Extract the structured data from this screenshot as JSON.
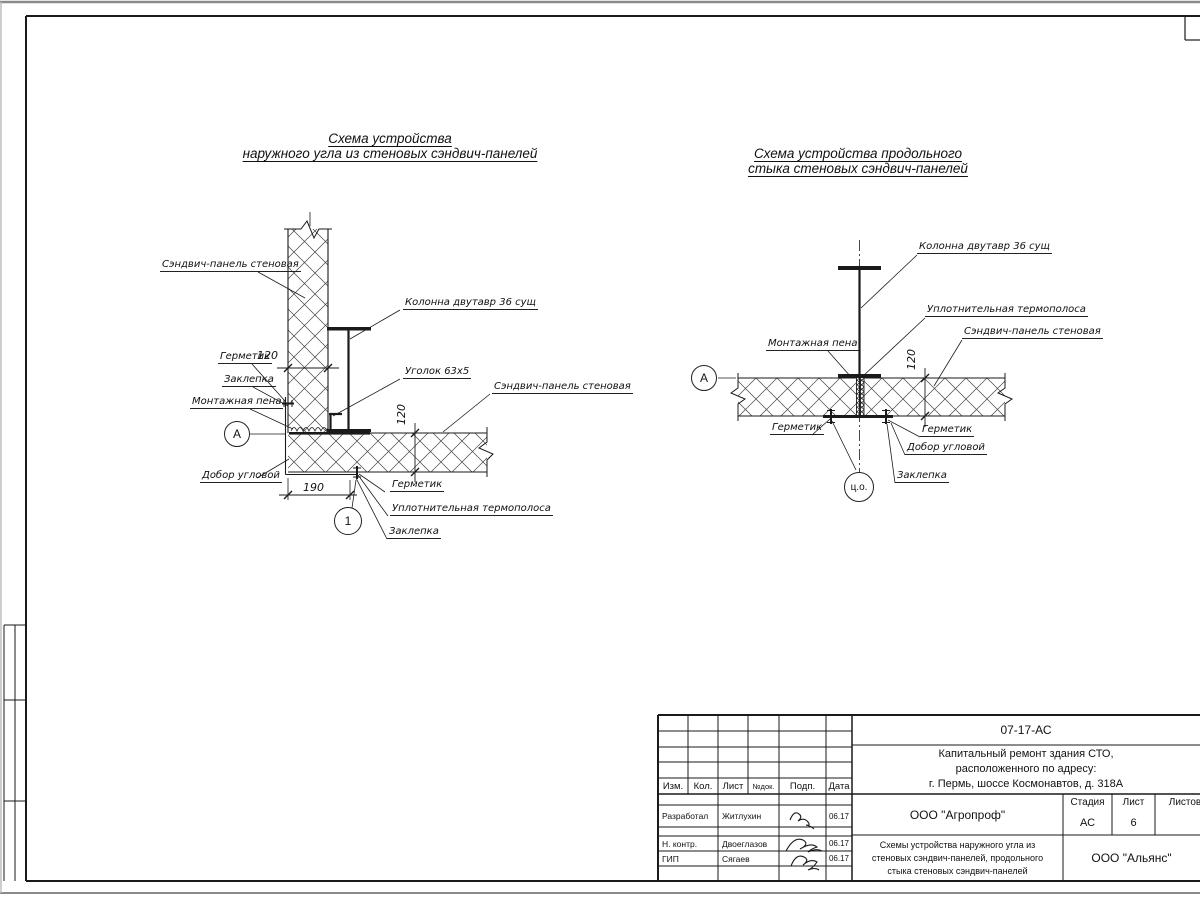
{
  "diagram_left": {
    "title1": "Схема устройства",
    "title2": "наружного угла из стеновых сэндвич-панелей",
    "label_panel": "Сэндвич-панель стеновая",
    "label_column": "Колонна двутавр 36 сущ",
    "label_angle": "Уголок 63х5",
    "label_sealant": "Герметик",
    "label_rivet": "Заклепка",
    "label_foam": "Монтажная пена",
    "label_corner_trim": "Добор угловой",
    "label_panel2": "Сэндвич-панель стеновая",
    "label_sealant2": "Герметик",
    "label_thermal": "Уплотнительная термополоса",
    "label_rivet2": "Заклепка",
    "dim_wall": "120",
    "dim_panel": "120",
    "dim_width": "190",
    "marker_a": "А",
    "marker_1": "1"
  },
  "diagram_right": {
    "title1": "Схема устройства продольного",
    "title2": "стыка стеновых сэндвич-панелей",
    "label_column": "Колонна двутавр 36 сущ",
    "label_thermal": "Уплотнительная термополоса",
    "label_panel": "Сэндвич-панель стеновая",
    "label_foam": "Монтажная пена",
    "label_sealant_left": "Герметик",
    "label_sealant_right": "Герметик",
    "label_corner_trim": "Добор угловой",
    "label_rivet": "Заклепка",
    "dim_panel": "120",
    "marker_a": "А",
    "marker_co": "ц.о."
  },
  "title_block": {
    "code": "07-17-АС",
    "project_line1": "Капитальный ремонт здания СТО,",
    "project_line2": "расположенного по адресу:",
    "project_line3": "г. Пермь, шоссе Космонавтов, д. 318А",
    "org": "ООО \"Агропроф\"",
    "doc_line1": "Схемы устройства наружного угла из",
    "doc_line2": "стеновых сэндвич-панелей, продольного",
    "doc_line3": "стыка стеновых сэндвич-панелей",
    "company": "ООО \"Альянс\"",
    "col_izm": "Изм.",
    "col_kol": "Кол.",
    "col_list": "Лист",
    "col_ndok": "№док.",
    "col_podp": "Подп.",
    "col_data": "Дата",
    "stage_header": "Стадия",
    "sheet_header": "Лист",
    "sheets_header": "Листов",
    "stage_value": "АС",
    "sheet_value": "6",
    "rows": [
      {
        "role": "Разработал",
        "name": "Житлухин",
        "date": "06.17"
      },
      {
        "role": "Н. контр.",
        "name": "Двоеглазов",
        "date": "06.17"
      },
      {
        "role": "ГИП",
        "name": "Сягаев",
        "date": "06.17"
      }
    ]
  }
}
